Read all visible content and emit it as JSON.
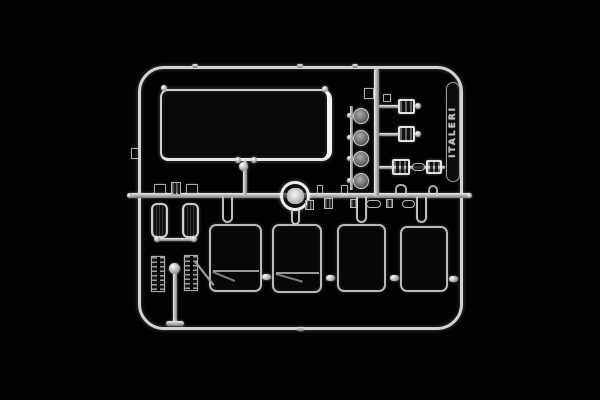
{
  "photo": {
    "type": "product-photo",
    "subject": "clear transparent plastic model kit sprue (parts runner) photographed on black",
    "background_color": "#000000",
    "plastic_color": "clear with white/grey edge highlights"
  },
  "sprue": {
    "brand_text": "ITALERI",
    "parts_visible": [
      "large-windshield-glass",
      "round-headlight-lens-x4",
      "clearance-light-housing-x4",
      "side-window-pane-x4",
      "small-dark-side-window-x2",
      "ribbed-grille-step-x2",
      "dome-light-ring",
      "small-lens-pill-x2",
      "small-clip-chips"
    ]
  }
}
